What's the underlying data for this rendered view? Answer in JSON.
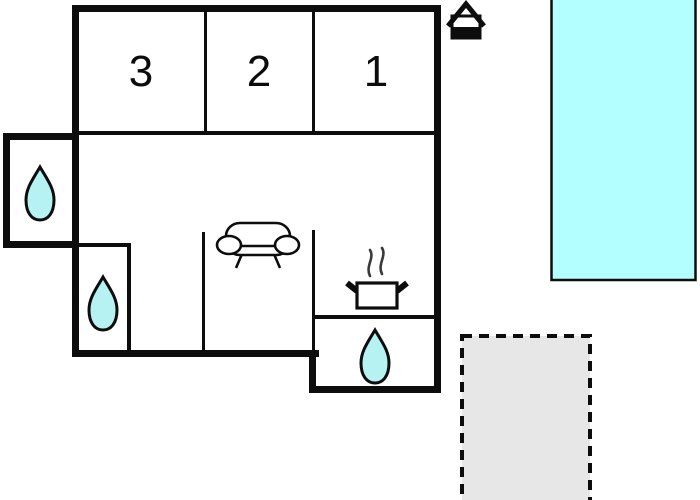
{
  "colors": {
    "background": "#ffffff",
    "wall": "#0d0d0d",
    "drop_fill": "#b6f2f2",
    "pool_fill": "#b3ffff",
    "terrace_fill": "#e7e7e7",
    "icon_stroke": "#0d0d0d"
  },
  "rooms": [
    {
      "label": "3"
    },
    {
      "label": "2"
    },
    {
      "label": "1"
    }
  ],
  "features": {
    "entrance_icon": "house-entrance-marker",
    "water_drop_count": 3,
    "living_area_icon": "sofa",
    "kitchen_icon": "cooking-pot-with-steam",
    "outdoor_pool": "swimming-pool",
    "outdoor_terrace": "dashed-terrace-area"
  }
}
